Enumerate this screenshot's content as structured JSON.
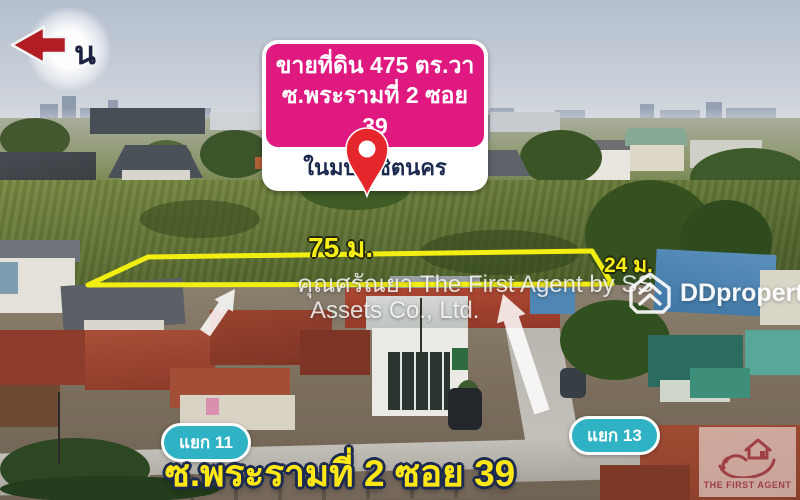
{
  "north_indicator": {
    "label": "น",
    "arrow_color": "#b21d23"
  },
  "listing_banner": {
    "title_line1": "ขายที่ดิน 475 ตร.วา",
    "title_line2": "ซ.พระรามที่ 2 ซอย 39",
    "subtitle": "ในมบ.วิชิตนคร",
    "bg_color": "#df1980",
    "text_color": "#ffffff",
    "subtitle_color": "#1c2a4e"
  },
  "map_pin": {
    "color": "#e5262b"
  },
  "plot": {
    "frontage_label": "75 ม.",
    "depth_label": "24 ม.",
    "outline_color": "#f2ee12",
    "label_color": "#f6ee14"
  },
  "watermark": {
    "line1": "คุณศรัณยา The First Agent by SS",
    "line2": "Assets Co., Ltd."
  },
  "ddproperty_logo": {
    "label": "DDproperty"
  },
  "junction_labels": [
    {
      "label": "แยก 11"
    },
    {
      "label": "แยก 13"
    }
  ],
  "road_label": {
    "text": "ซ.พระรามที่ 2 ซอย 39",
    "color": "#ffe716",
    "outline_color": "#1d2b50"
  },
  "agency_logo": {
    "name": "THE FIRST AGENT",
    "color": "#9e3f45"
  },
  "junction_pill_color": "#2fb3c4"
}
